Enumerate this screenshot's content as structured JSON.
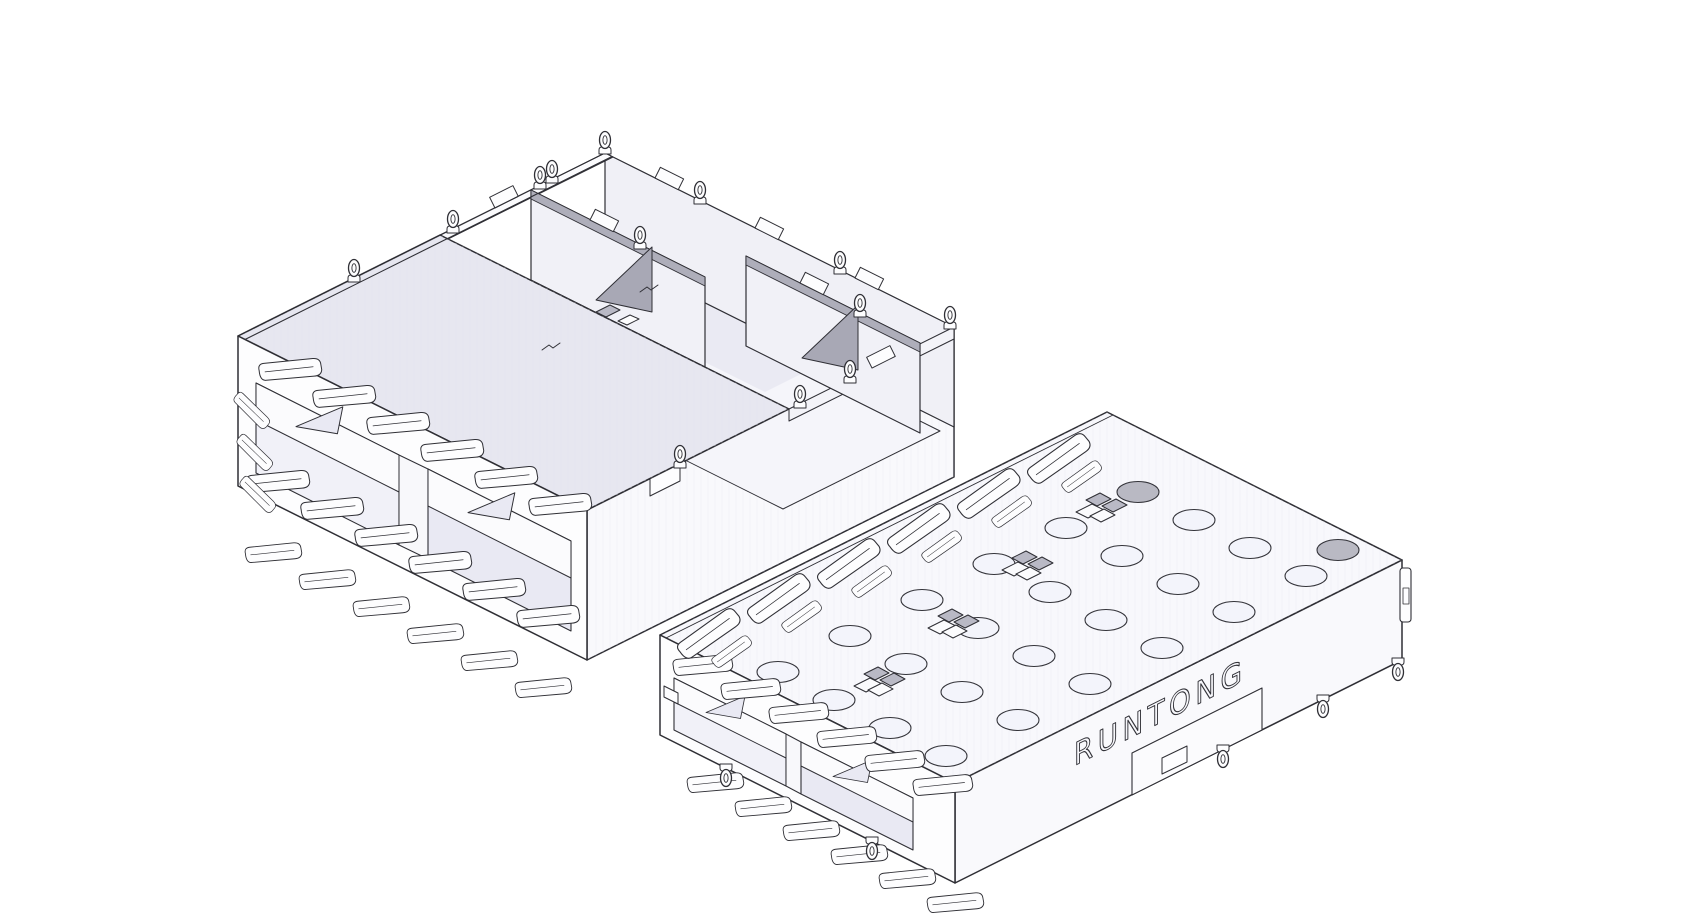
{
  "page": {
    "background": "#ffffff"
  },
  "scene": {
    "type": "cad-isometric-line-render",
    "description": "Two isometric CAD renderings of a sheet-metal 1x2 SFP cage connector shell on a white background",
    "colors": {
      "outline": "#2f2f35",
      "face_white": "#fdfdfe",
      "face_light": "#f9f9fc",
      "panel_lavender": "#e7e7f0",
      "port_interior": "#f1f1f8",
      "port_interior_tint": "#e9e9f3",
      "inner_wall": "#f0f0f6",
      "gusset_gray": "#a8a8b5",
      "tab_gray": "#b9b9c5",
      "hole_dark": "#b9b9c3"
    },
    "left_cage": {
      "label": "cage-rear-top-view",
      "ports": 2,
      "triangle_cutouts": 2,
      "smooth_top_cover": true,
      "open_back": true,
      "floor_holes": 3,
      "transverse_walls": 2,
      "gussets": 2,
      "emi_fingers_per_band": 6,
      "edge_eyelets": 13
    },
    "right_cage": {
      "label": "cage-front-top-view",
      "brand_text": "RUNTONG",
      "ports": 2,
      "triangle_cutouts": 2,
      "vent_hole_grid": {
        "rows": 4,
        "cols": 6
      },
      "dark_vent_holes": 2,
      "latch_tab_clusters": 4,
      "emi_fingers_per_band": 6,
      "bottom_pin_eyelets": 5
    }
  }
}
